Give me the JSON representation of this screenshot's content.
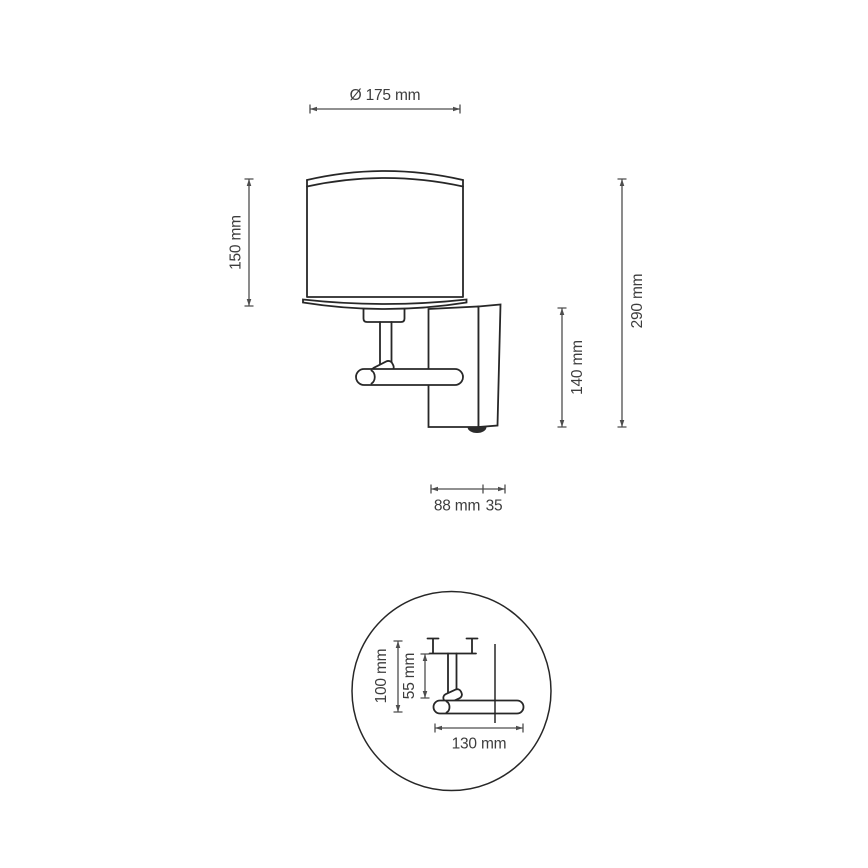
{
  "page": {
    "background_color": "#ffffff"
  },
  "drawing": {
    "kind": "technical-dimension-drawing",
    "subject": "wall lamp with cylindrical shade and rectangular wall plate",
    "line_color": "#272727",
    "dimension_line_color": "#4d4d4d",
    "label_color": "#3d3d3d",
    "front_view": {
      "shade_diameter_label": "Ø 175 mm",
      "shade_height_label": "150 mm",
      "bracket_height_label": "140 mm",
      "overall_height_label": "290 mm",
      "arm_depth_label": "88 mm",
      "plate_depth_label": "35"
    },
    "detail_view": {
      "overall_drop_label": "100 mm",
      "stem_drop_label": "55 mm",
      "arm_length_label": "130 mm"
    }
  }
}
